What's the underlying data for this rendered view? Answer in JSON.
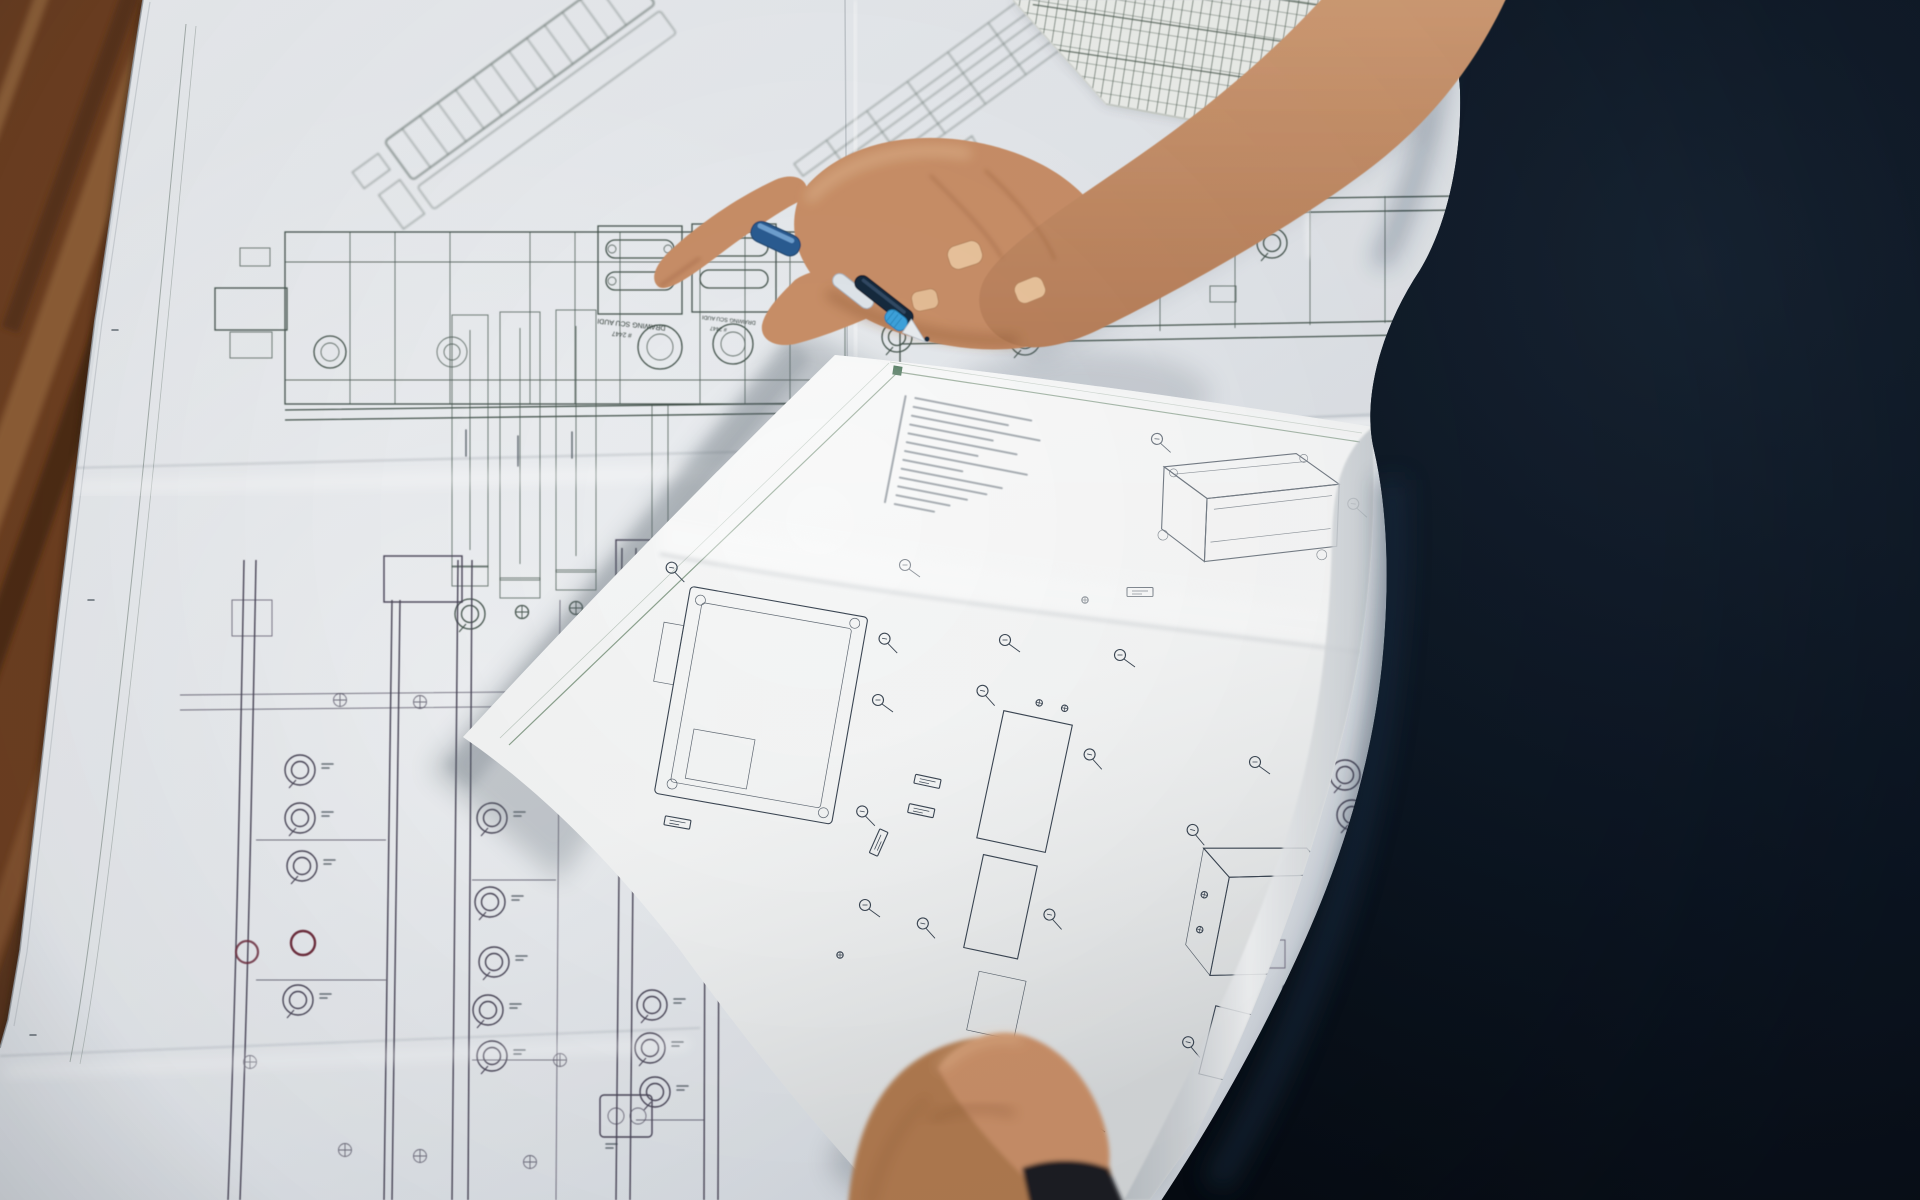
{
  "photo": {
    "alt": "Top-down photograph: a person in a dark navy shirt holds a small sheet of dense mechanical part drawings and a blue ballpoint pen over large folded technical blueprints spread on a dark wooden table"
  },
  "large_blueprint": {
    "title_label": "DRAWING SCU AUDI",
    "drawing_number": "# 2447",
    "paper": "#dee2e7",
    "ink": "#47564f",
    "ink_lower": "#4b4759",
    "accent_red": "#6e2f3e",
    "gold_contacts": "#c9a23f"
  },
  "hand_sheet": {
    "paper": "#f6f7f7",
    "ink": "#3b4653",
    "border": "#5f7f63",
    "corner_mark": "#2f5f3f"
  },
  "grid_sheet": {
    "paper": "#eef0ec",
    "ink": "#5c6b60"
  },
  "pen": {
    "cap": "#2c5c92",
    "barrel": "#16293e",
    "grip": "#3da2dc",
    "tip": "#e8ecef"
  },
  "wood_table": {
    "base": "#6e3f20",
    "dark": "#462813",
    "light": "#9a6a3e"
  },
  "person": {
    "shirt": "#0b1420",
    "shirt_highlight": "#1e3347",
    "skin": "#c98f68",
    "skin_shadow": "#9a6241",
    "nail": "#e9c39c"
  },
  "watch": {
    "band": "#1a1d22"
  }
}
